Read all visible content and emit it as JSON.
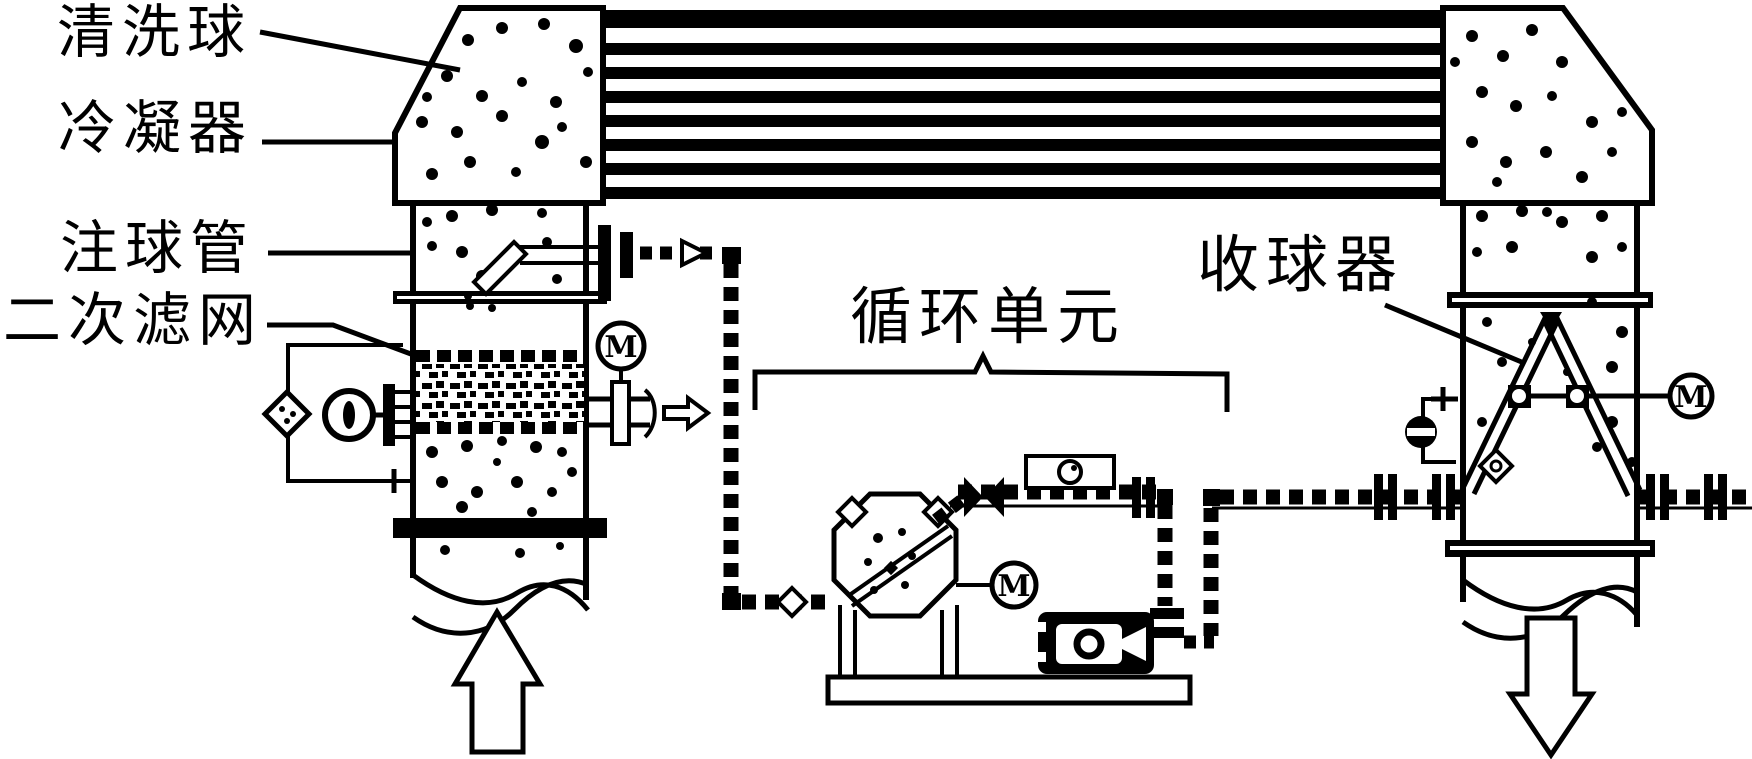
{
  "labels": {
    "cleaning_ball": "清洗球",
    "condenser": "冷凝器",
    "ball_injection_pipe": "注球管",
    "secondary_filter": "二次滤网",
    "circulation_unit": "循环单元",
    "ball_collector": "收球器"
  },
  "instruments": {
    "filter_gauge": "M",
    "circulation_gauge": "M",
    "collector_gauge": "M"
  },
  "colors": {
    "line": "#000000",
    "background": "#ffffff"
  }
}
